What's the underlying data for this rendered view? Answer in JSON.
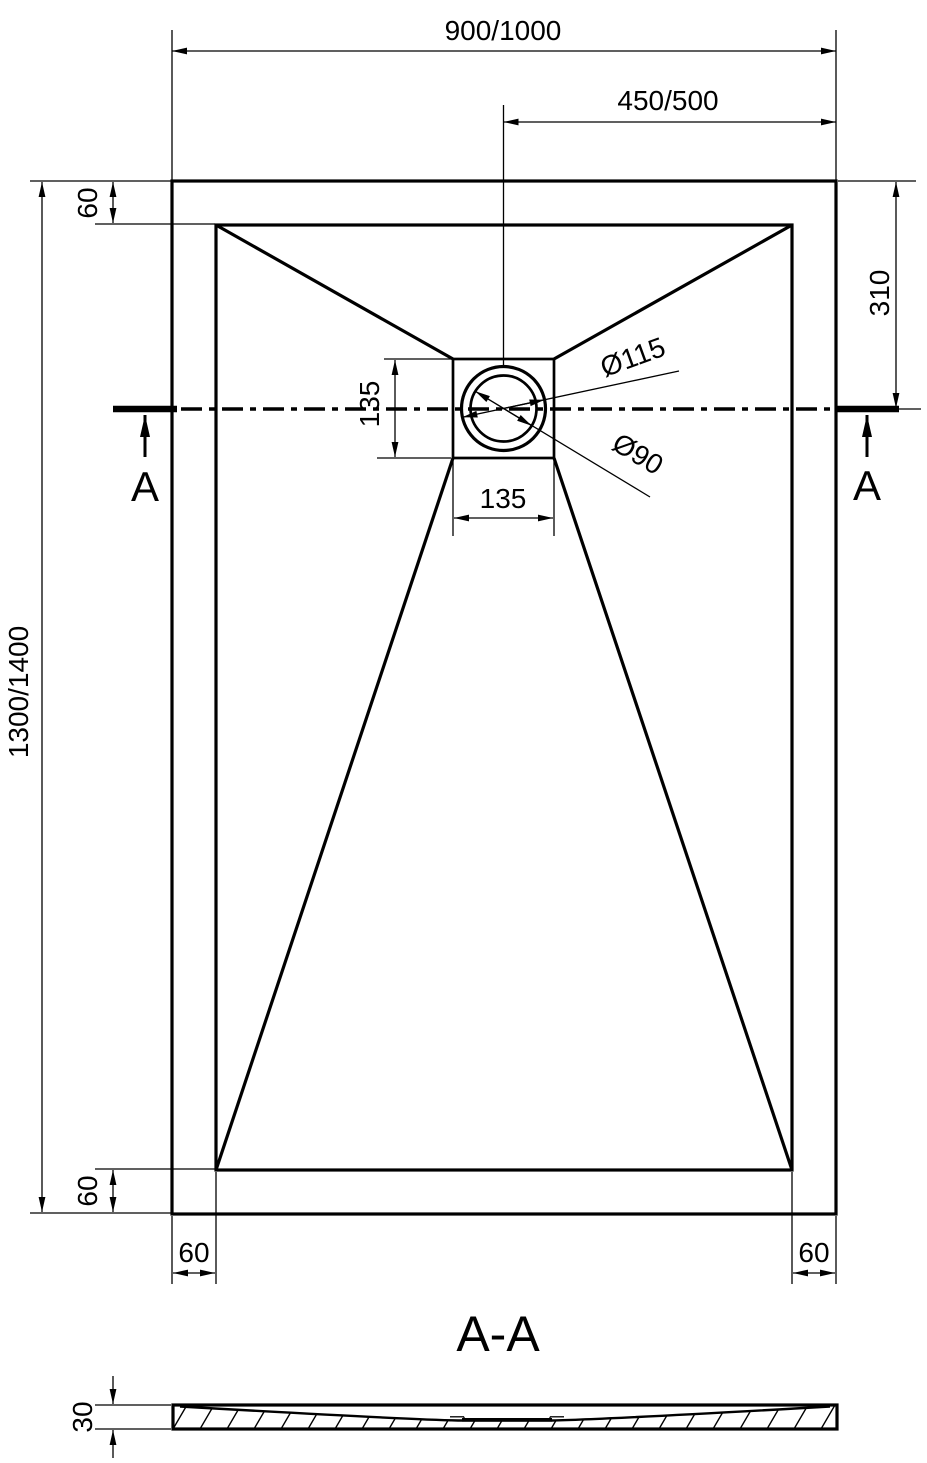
{
  "drawing": {
    "colors": {
      "ink": "#000000",
      "background": "#ffffff"
    },
    "top_view": {
      "dim_overall_width": "900/1000",
      "dim_drain_offset_from_right": "450/500",
      "dim_overall_length": "1300/1400",
      "dim_rim_top": "60",
      "dim_rim_bottom": "60",
      "dim_rim_bottom_left": "60",
      "dim_rim_bottom_right": "60",
      "dim_drain_center_from_top": "310",
      "dim_drain_square_height": "135",
      "dim_drain_square_width": "135",
      "dia_drain_flange": "Ø115",
      "dia_drain_hole": "Ø90",
      "section_mark_left": "A",
      "section_mark_right": "A"
    },
    "section_view": {
      "title": "A-A",
      "dim_thickness": "30"
    }
  }
}
